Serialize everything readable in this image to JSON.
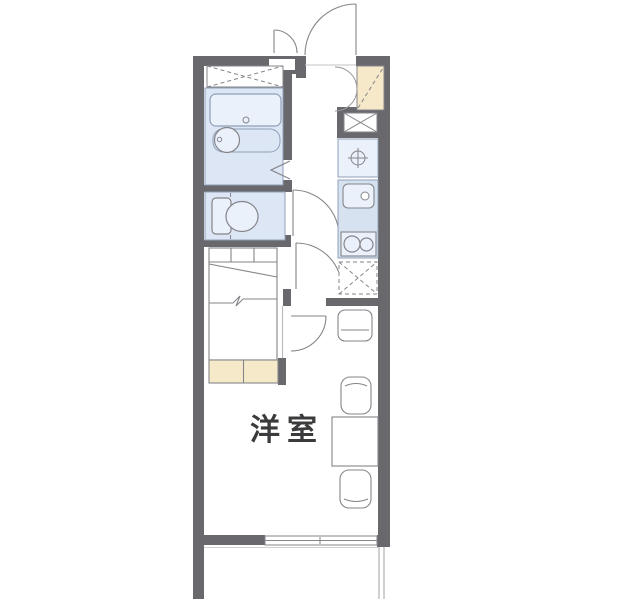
{
  "floor_plan": {
    "room_label": "洋室",
    "colors": {
      "background": "#ffffff",
      "wall": "#68686d",
      "wet_area_fill": "#dce6f4",
      "fixture_fill": "#eaf1fa",
      "kitchen_fill": "#d7e2f1",
      "cabinet_fill": "#f6e9ca",
      "fixture_stroke": "#85858a",
      "wet_stroke": "#8fa0b8",
      "light_line": "#b9b9bd",
      "text": "#3b3b3d"
    },
    "fixtures": [
      "entrance-door",
      "service-door",
      "shoe-cabinet",
      "storage-closet",
      "bathtub",
      "washbasin",
      "bathroom-folding-door",
      "toilet",
      "toilet-door",
      "interior-door",
      "room-door",
      "bed",
      "washing-machine-space",
      "water-heater",
      "kitchen-sink",
      "gas-stove",
      "refrigerator-space",
      "stool",
      "chair",
      "dining-table",
      "sliding-window",
      "balcony"
    ]
  }
}
